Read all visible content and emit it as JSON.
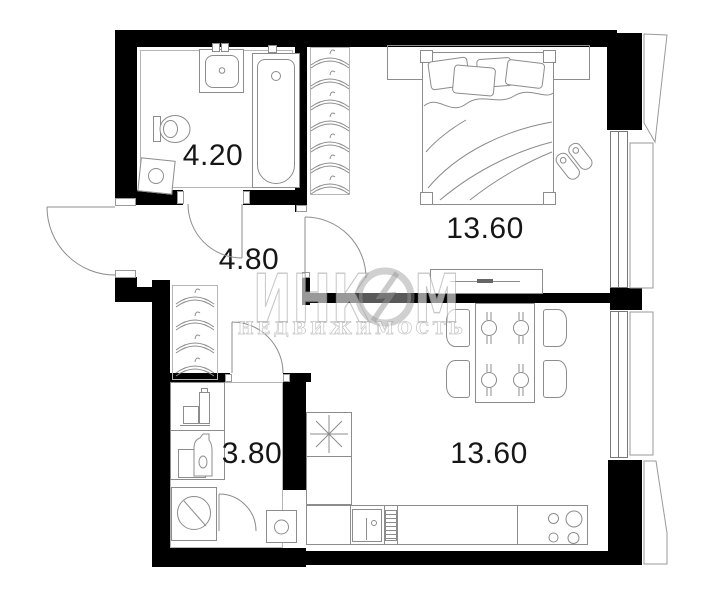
{
  "rooms": [
    {
      "name": "bathroom",
      "area_label": "4.20"
    },
    {
      "name": "hallway",
      "area_label": "4.80"
    },
    {
      "name": "bedroom",
      "area_label": "13.60"
    },
    {
      "name": "storage",
      "area_label": "3.80"
    },
    {
      "name": "kitchen-living",
      "area_label": "13.60"
    }
  ],
  "watermark": {
    "brand_left": "ИНК",
    "brand_right": "М",
    "subtitle": "НЕДВИЖИМОСТЬ"
  },
  "colors": {
    "wall": "#000000",
    "line": "#8c8c8c",
    "room_outline": "#b5b5b5",
    "label": "#161616",
    "watermark": "#bdbdbd"
  },
  "icons": [
    "hanger-icon",
    "burst-star-icon",
    "lightning-logo-icon",
    "stove-burners-icon",
    "sink-icon",
    "bathtub-icon",
    "toilet-icon",
    "washing-machine-icon",
    "bed-icon",
    "slippers-icon",
    "dining-table-icon",
    "radiator-icon",
    "detergent-icon",
    "door-arc-icon"
  ]
}
